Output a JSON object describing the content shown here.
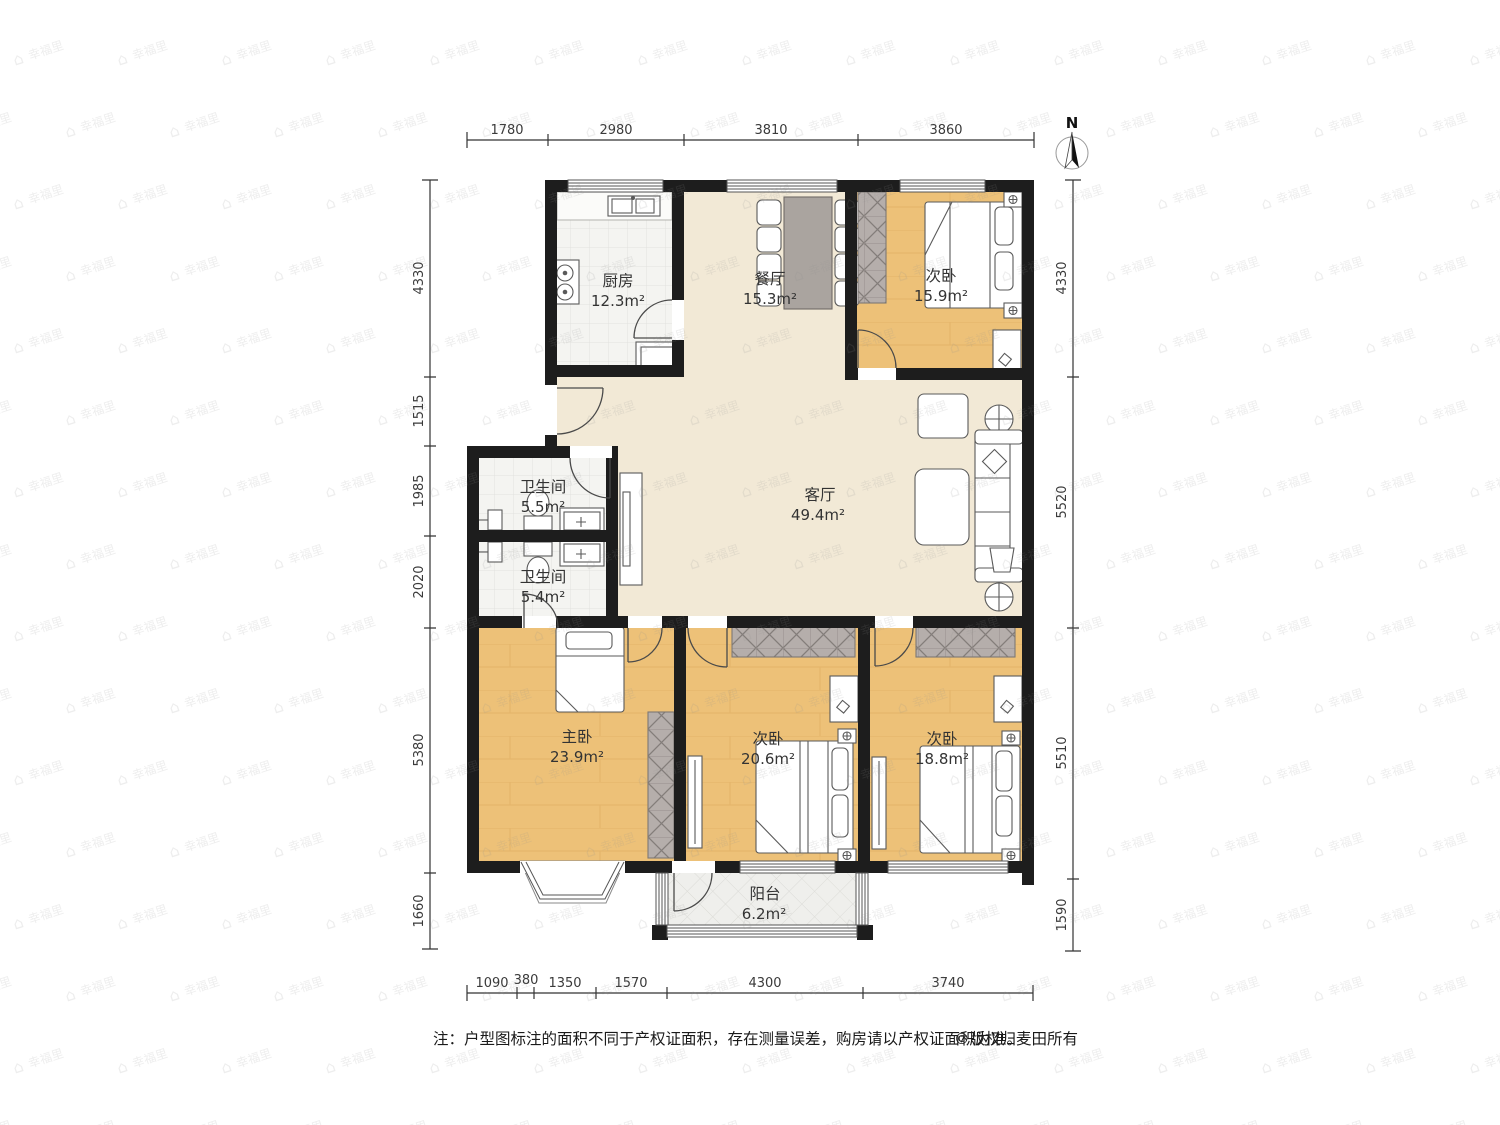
{
  "watermark": {
    "text": "幸福里",
    "icon": "house-icon"
  },
  "compass": {
    "label": "N"
  },
  "rooms": {
    "kitchen": {
      "name": "厨房",
      "area": "12.3m²"
    },
    "dining": {
      "name": "餐厅",
      "area": "15.3m²"
    },
    "bedroom_ne": {
      "name": "次卧",
      "area": "15.9m²"
    },
    "living": {
      "name": "客厅",
      "area": "49.4m²"
    },
    "bath_upper": {
      "name": "卫生间",
      "area": "5.5m²"
    },
    "bath_lower": {
      "name": "卫生间",
      "area": "5.4m²"
    },
    "master": {
      "name": "主卧",
      "area": "23.9m²"
    },
    "bedroom_s_mid": {
      "name": "次卧",
      "area": "20.6m²"
    },
    "bedroom_se": {
      "name": "次卧",
      "area": "18.8m²"
    },
    "balcony": {
      "name": "阳台",
      "area": "6.2m²"
    }
  },
  "dimensions": {
    "top": [
      "1780",
      "2980",
      "3810",
      "3860"
    ],
    "bottom": [
      "1090",
      "380",
      "1350",
      "1570",
      "4300",
      "3740"
    ],
    "left": [
      "4330",
      "1515",
      "1985",
      "2020",
      "5380",
      "1660"
    ],
    "right": [
      "4330",
      "5520",
      "5510",
      "1590"
    ]
  },
  "footer": {
    "note": "注：户型图标注的面积不同于产权证面积，存在测量误差，购房请以产权证面积为准。",
    "copyright": "©版权归麦田所有"
  },
  "colors": {
    "wall": "#1d1d1d",
    "wood_floor": "#edc178",
    "cream_floor": "#f2e9d6",
    "tile_floor": "#f4f4f1",
    "wardrobe": "#b5aeab",
    "table": "#aaa49f"
  }
}
